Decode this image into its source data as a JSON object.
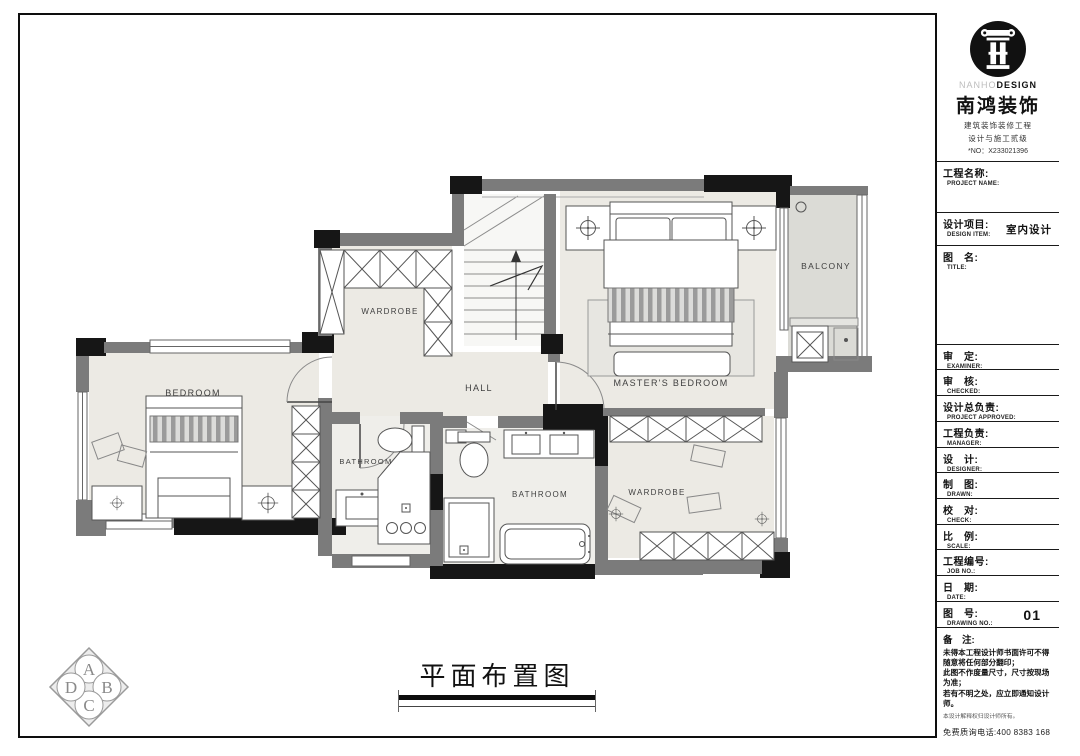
{
  "sheet": {
    "main_title": "平面布置图"
  },
  "logo": {
    "brand_en_light": "NANHO",
    "brand_en_bold": "DESIGN",
    "brand_cn": "南鸿装饰",
    "cert_line1": "建筑装饰装修工程",
    "cert_line2": "设计与施工贰级",
    "cert_no": "*NO：X233021396"
  },
  "title_block": {
    "rows": [
      {
        "cn": "工程名称:",
        "en": "PROJECT NAME:",
        "value": ""
      },
      {
        "cn": "设计项目:",
        "en": "DESIGN ITEM:",
        "value": "室内设计"
      },
      {
        "cn": "图　名:",
        "en": "TITLE:",
        "value": ""
      },
      {
        "cn": "审　定:",
        "en": "EXAMINER:",
        "value": ""
      },
      {
        "cn": "审　核:",
        "en": "CHECKED:",
        "value": ""
      },
      {
        "cn": "设计总负责:",
        "en": "PROJECT APPROVED:",
        "value": ""
      },
      {
        "cn": "工程负责:",
        "en": "MANAGER:",
        "value": ""
      },
      {
        "cn": "设　计:",
        "en": "DESIGNER:",
        "value": ""
      },
      {
        "cn": "制　图:",
        "en": "DRAWN:",
        "value": ""
      },
      {
        "cn": "校　对:",
        "en": "CHECK:",
        "value": ""
      },
      {
        "cn": "比　例:",
        "en": "SCALE:",
        "value": ""
      },
      {
        "cn": "工程编号:",
        "en": "JOB  NO.:",
        "value": ""
      },
      {
        "cn": "日　期:",
        "en": "DATE:",
        "value": ""
      },
      {
        "cn": "图　号:",
        "en": "DRAWING NO.:",
        "value": "01"
      }
    ],
    "notes": {
      "label": "备　注:",
      "lines": [
        "未得本工程设计师书面许可不得随意将任何部分翻印；",
        "此图不作度量尺寸，尺寸按现场为准；",
        "若有不明之处，应立即通知设计师。"
      ],
      "fine_print": "本设计解释权归设计师所有。",
      "hotline": "免费质询电话:400 8383 168"
    }
  },
  "plan": {
    "rooms": [
      "BEDROOM",
      "WARDROBE",
      "HALL",
      "MASTER'S BEDROOM",
      "BALCONY",
      "BATHROOM",
      "BATHROOM",
      "WARDROBE"
    ]
  },
  "compass": {
    "letters": [
      "A",
      "B",
      "C",
      "D"
    ]
  },
  "colors": {
    "wall": "#7b7b7b",
    "accent_black": "#161616",
    "floor": "#eceae4",
    "balcony_floor": "#dbdbd6"
  }
}
